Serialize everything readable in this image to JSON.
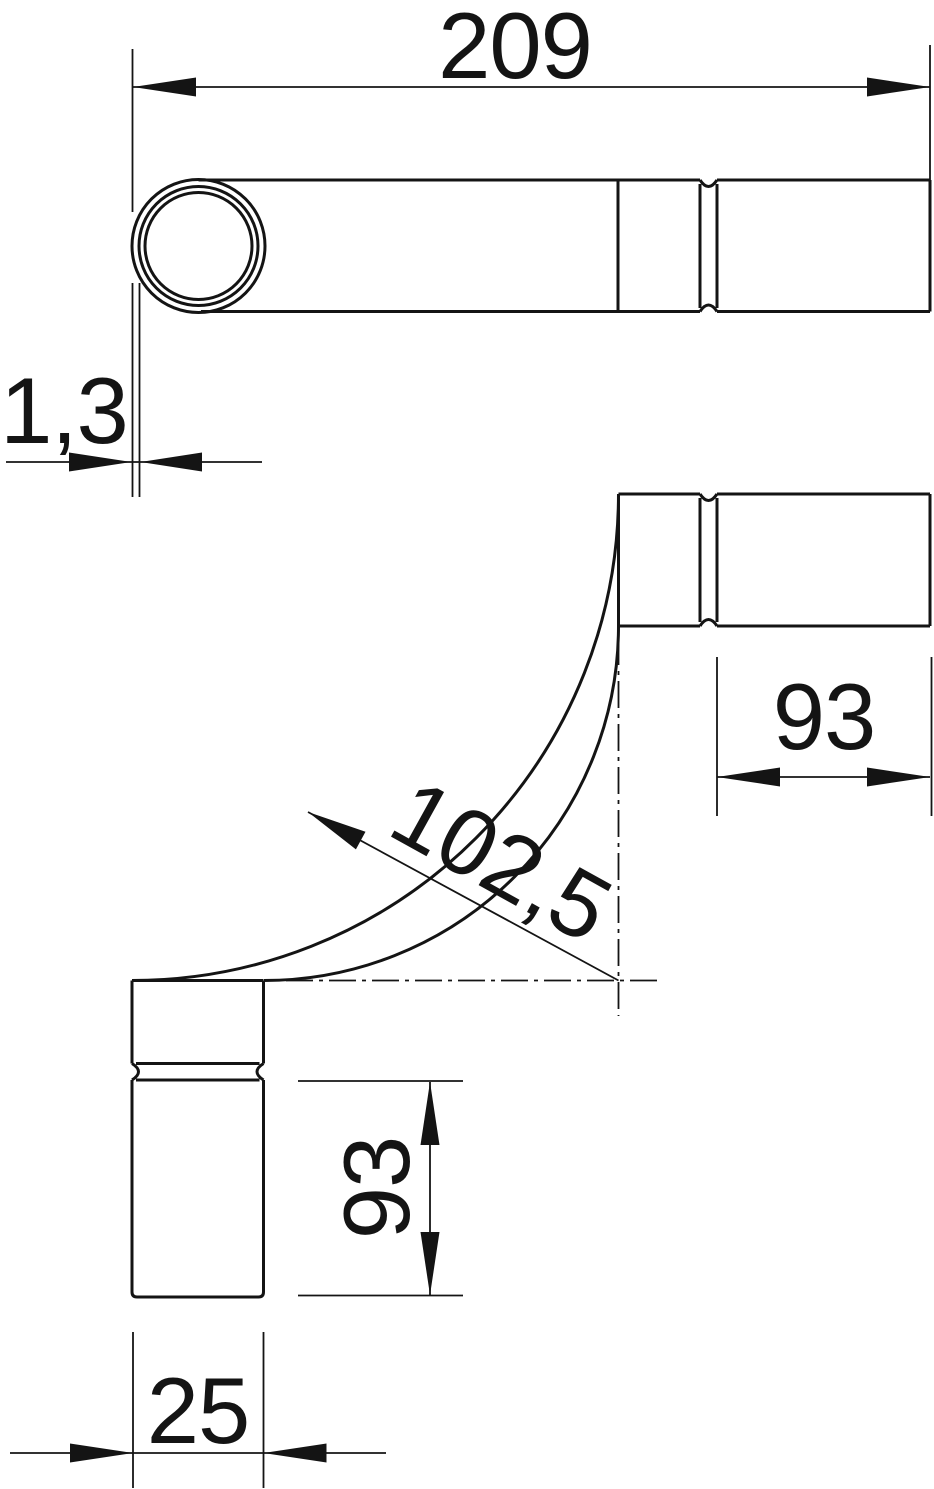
{
  "drawing": {
    "title": "pipe-bend-technical-drawing",
    "background_color": "#ffffff",
    "line_color": "#141414",
    "views": {
      "side_view": "straight pipe side view with end opening circle and socket groove",
      "bend_view": "90 degree pipe bend with socket ends and centerlines"
    },
    "dimensions": {
      "overall_length": {
        "value": "209"
      },
      "wall_thickness": {
        "value": "1,3"
      },
      "socket_top": {
        "value": "93"
      },
      "bend_radius": {
        "value": "102,5"
      },
      "socket_bottom": {
        "value": "93"
      },
      "outer_diameter": {
        "value": "25"
      }
    }
  }
}
